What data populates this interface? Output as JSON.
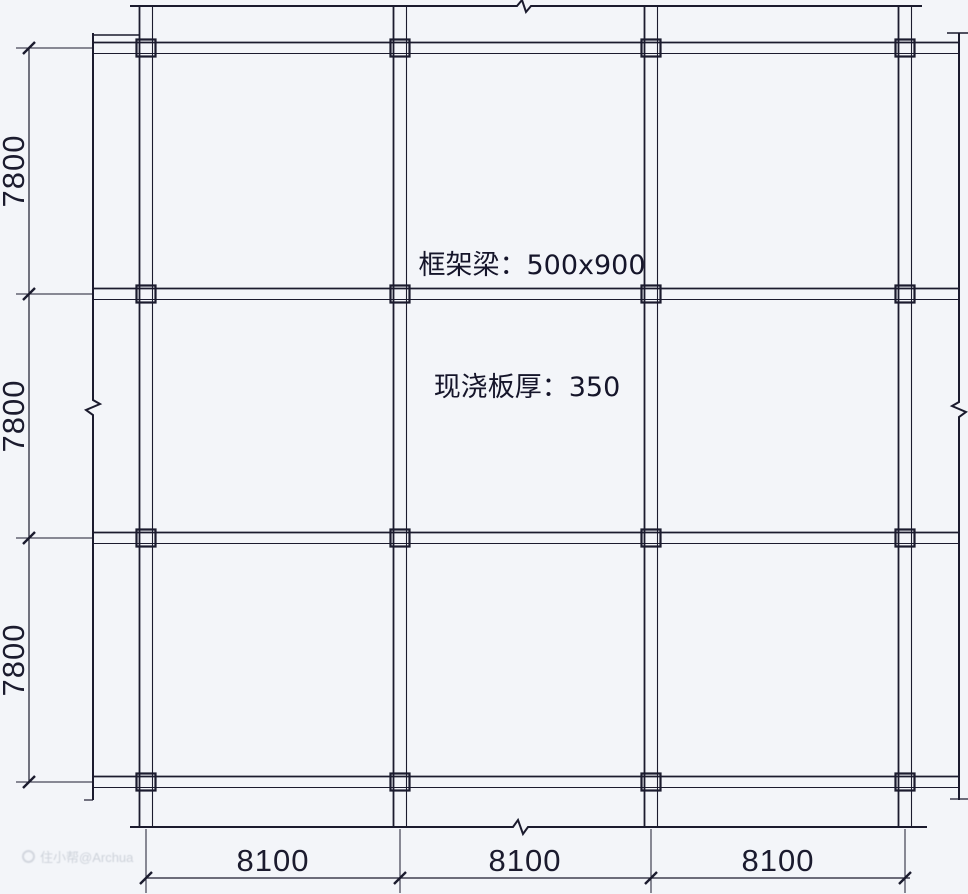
{
  "plan": {
    "annotations": {
      "beam": "框架梁：500x900",
      "slab": "现浇板厚：350"
    },
    "dimensions": {
      "left": [
        "7800",
        "7800",
        "7800"
      ],
      "bottom": [
        "8100",
        "8100",
        "8100"
      ]
    },
    "grid": {
      "bays_x": 3,
      "bays_y": 3,
      "bay_width_mm": 8100,
      "bay_height_mm": 7800
    },
    "watermark": {
      "icon": "watermark-logo-icon",
      "text": "住小帮@Archua"
    },
    "colors": {
      "line": "#1b1b2e",
      "background": "#f3f5f9",
      "watermark": "#cdd2da"
    }
  }
}
